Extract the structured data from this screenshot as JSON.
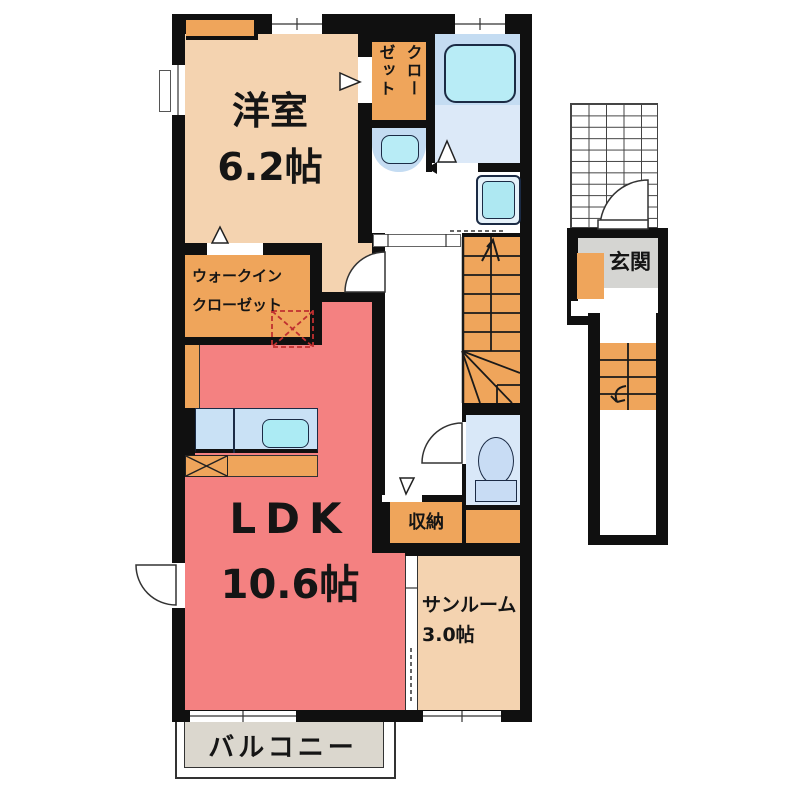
{
  "title": "2F floor plan",
  "colors": {
    "wall": "#101010",
    "bedroom_fill": "#F4D3B0",
    "closet_fill": "#EFA55B",
    "ldk_fill": "#F48181",
    "bath_panel": "#C4DCF2",
    "bath_floor": "#DCE9F8",
    "fixture_cyan": "#B8ECF6",
    "toilet_fill": "#D9E8F8",
    "kitchen_fill": "#C9E1F5",
    "balcony_fill": "#DBD7CE",
    "entrance_mat": "#D5D5D2",
    "dashed_box": "#C03030"
  },
  "rooms": {
    "bedroom": {
      "name": "洋室",
      "size": "6.2帖"
    },
    "closet": {
      "label": "クローゼット",
      "column_left": "ゼット",
      "column_right": "クロー"
    },
    "walk_in_closet": {
      "line1": "ウォークイン",
      "line2": "クローゼット"
    },
    "ldk": {
      "name": "LDK",
      "size": "10.6帖"
    },
    "storage": {
      "label": "収納"
    },
    "sunroom": {
      "name": "サンルーム",
      "size": "3.0帖"
    },
    "balcony": {
      "label": "バルコニー"
    },
    "entrance": {
      "label": "玄関"
    }
  }
}
